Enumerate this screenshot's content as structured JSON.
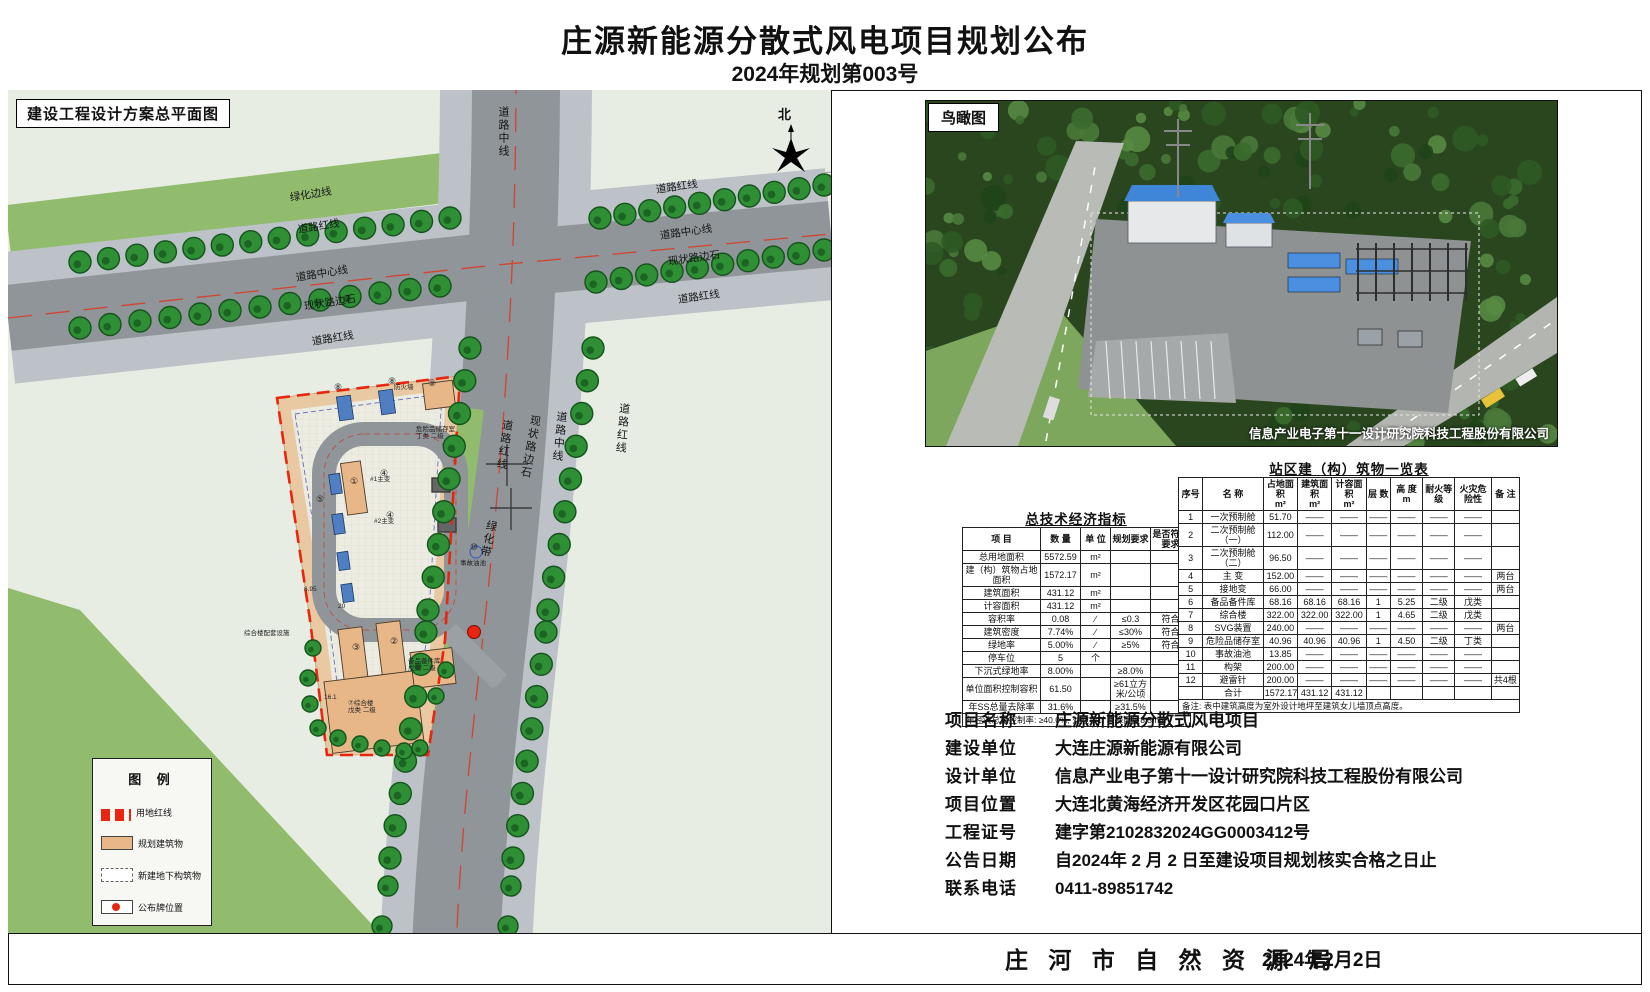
{
  "page": {
    "title": "庄源新能源分散式风电项目规划公布",
    "subtitle": "2024年规划第003号",
    "footer_agency": "庄 河 市 自 然 资 源 局",
    "footer_date": "2024年2月2日"
  },
  "site_plan": {
    "panel_title": "建设工程设计方案总平面图",
    "compass_label": "北",
    "road_labels": [
      "绿化边线",
      "道路红线",
      "道路中心线",
      "现状路边石",
      "道路红线",
      "道路红线",
      "道路中心线",
      "现状路边石",
      "道路红线",
      "道路中线",
      "道路红线",
      "现状路边石",
      "道路中线",
      "道路红线",
      "绿化带"
    ],
    "annotations": [
      "防火墙",
      "危险品储存室\n丁类 二级",
      "#1主变",
      "#2主变",
      "事故油池",
      "⑦综合楼\n戊类 二级",
      "备品备件库\n戊类 二级",
      "综合楼配套设施",
      "6.95",
      "20",
      "16.1"
    ],
    "circled_marks": [
      "⑧",
      "⑧",
      "⑨",
      "⑤",
      "①",
      "④",
      "④",
      "③",
      "②",
      "⑩"
    ],
    "legend": {
      "title": "图 例",
      "items": [
        {
          "label": "用地红线",
          "swatch": "redline"
        },
        {
          "label": "规划建筑物",
          "swatch": "building"
        },
        {
          "label": "新建地下构筑物",
          "swatch": "underground"
        },
        {
          "label": "公布牌位置",
          "swatch": "board"
        }
      ]
    },
    "colors": {
      "site_boundary": "#e8250f",
      "planned_building": "#e8b788",
      "road": "#8f9598",
      "greenbelt": "#92bc6d"
    }
  },
  "birds_eye": {
    "panel_title": "鸟瞰图",
    "caption": "信息产业电子第十一设计研究院科技工程股份有限公司"
  },
  "economic_table": {
    "title": "总技术经济指标",
    "headers": [
      "项  目",
      "数  量",
      "单 位",
      "规划要求",
      "是否符合要求"
    ],
    "rows": [
      [
        "总用地面积",
        "5572.59",
        "m²",
        "",
        ""
      ],
      [
        "建（构）筑物占地面积",
        "1572.17",
        "m²",
        "",
        ""
      ],
      [
        "建筑面积",
        "431.12",
        "m²",
        "",
        ""
      ],
      [
        "计容面积",
        "431.12",
        "m²",
        "",
        ""
      ],
      [
        "容积率",
        "0.08",
        "∕",
        "≤0.3",
        "符合"
      ],
      [
        "建筑密度",
        "7.74%",
        "∕",
        "≤30%",
        "符合"
      ],
      [
        "绿地率",
        "5.00%",
        "∕",
        "≥5%",
        "符合"
      ],
      [
        "停车位",
        "5",
        "个",
        "",
        ""
      ],
      [
        "下沉式绿地率",
        "8.00%",
        "",
        "≥8.0%",
        ""
      ],
      [
        "单位面积控制容积",
        "61.50",
        "",
        "≥61立方米/公顷",
        ""
      ],
      [
        "年SS总量去除率",
        "31.6%",
        "",
        "≥31.5%",
        ""
      ]
    ],
    "footnote": "年径流总量控制率: ≥40.0%, 对应设计日降雨量8.5mm"
  },
  "buildings_table": {
    "title": "站区建（构）筑物一览表",
    "headers": [
      "序号",
      "名    称",
      "占地面积\nm²",
      "建筑面积\nm²",
      "计容面积\nm²",
      "层 数",
      "高 度\nm",
      "耐火等级",
      "火灾危险性",
      "备 注"
    ],
    "rows": [
      [
        "1",
        "一次预制舱",
        "51.70",
        "——",
        "——",
        "——",
        "——",
        "——",
        "——",
        ""
      ],
      [
        "2",
        "二次预制舱（一）",
        "112.00",
        "——",
        "——",
        "——",
        "——",
        "——",
        "——",
        ""
      ],
      [
        "3",
        "二次预制舱（二）",
        "96.50",
        "——",
        "——",
        "——",
        "——",
        "——",
        "——",
        ""
      ],
      [
        "4",
        "主 变",
        "152.00",
        "——",
        "——",
        "——",
        "——",
        "——",
        "——",
        "两台"
      ],
      [
        "5",
        "接地变",
        "66.00",
        "——",
        "——",
        "——",
        "——",
        "——",
        "——",
        "两台"
      ],
      [
        "6",
        "备品备件库",
        "68.16",
        "68.16",
        "68.16",
        "1",
        "5.25",
        "二级",
        "戊类",
        ""
      ],
      [
        "7",
        "综合楼",
        "322.00",
        "322.00",
        "322.00",
        "1",
        "4.65",
        "二级",
        "戊类",
        ""
      ],
      [
        "8",
        "SVG装置",
        "240.00",
        "——",
        "——",
        "——",
        "——",
        "——",
        "——",
        "两台"
      ],
      [
        "9",
        "危险品储存室",
        "40.96",
        "40.96",
        "40.96",
        "1",
        "4.50",
        "二级",
        "丁类",
        ""
      ],
      [
        "10",
        "事故油池",
        "13.85",
        "——",
        "——",
        "——",
        "——",
        "——",
        "——",
        ""
      ],
      [
        "11",
        "构架",
        "200.00",
        "——",
        "——",
        "——",
        "——",
        "——",
        "——",
        ""
      ],
      [
        "12",
        "避雷针",
        "200.00",
        "——",
        "——",
        "——",
        "——",
        "——",
        "——",
        "共4根"
      ],
      [
        "",
        "合计",
        "1572.17",
        "431.12",
        "431.12",
        "",
        "",
        "",
        "",
        ""
      ]
    ],
    "footnote": "备注: 表中建筑高度为室外设计地坪至建筑女儿墙顶点高度。"
  },
  "project_info": {
    "rows": [
      {
        "label": "项目名称",
        "value": "庄源新能源分散式风电项目"
      },
      {
        "label": "建设单位",
        "value": "大连庄源新能源有限公司"
      },
      {
        "label": "设计单位",
        "value": "信息产业电子第十一设计研究院科技工程股份有限公司"
      },
      {
        "label": "项目位置",
        "value": "大连北黄海经济开发区花园口片区"
      },
      {
        "label": "工程证号",
        "value": "建字第2102832024GG0003412号"
      },
      {
        "label": "公告日期",
        "value": "自2024年 2 月 2 日至建设项目规划核实合格之日止"
      },
      {
        "label": "联系电话",
        "value": "0411-89851742"
      }
    ]
  }
}
